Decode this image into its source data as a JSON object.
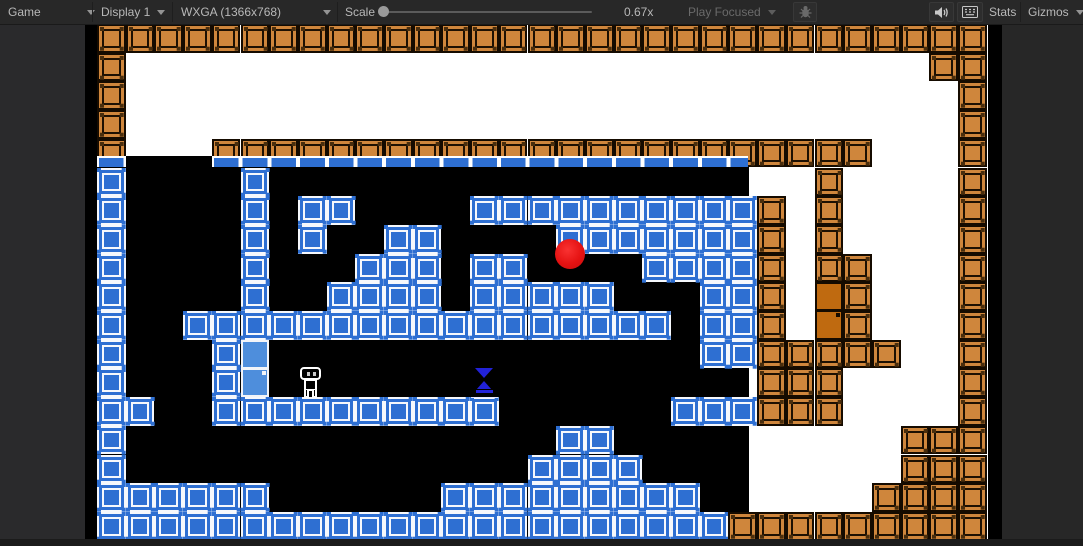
{
  "toolbar": {
    "game_tab": "Game",
    "display_dropdown": "Display 1",
    "resolution_dropdown": "WXGA (1366x768)",
    "scale_label": "Scale",
    "scale_value": "0.67x",
    "play_focused_label": "Play Focused",
    "stats_label": "Stats",
    "gizmos_label": "Gizmos",
    "icons": [
      "bug-icon",
      "audio-volume-icon",
      "keyboard-icon"
    ]
  },
  "editor": {
    "colors": {
      "toolbar_bg": "#282828",
      "panel_bg": "#2a2a2c",
      "bottom_strip": "#1b1b1b",
      "text": "#b8b8b8",
      "text_dim": "#6a6a6a"
    }
  },
  "game": {
    "grid": {
      "cols": 31,
      "rows": 18,
      "tile": 28.7,
      "origin_x": 12,
      "origin_y": 0
    },
    "legend": {
      "O": "orange-crate",
      "B": "blue-crate",
      ".": "cave-black",
      " ": "outside-white"
    },
    "map_rows": [
      "OOOOOOOOOOOOOOOOOOOOOOOOOOOOOOO",
      "O                            OO",
      "O                             O",
      "O                             O",
      "O   OOOOOOOOOOOOOOOOOOOOOOO   O",
      "B....B................   O    O",
      "B....B.BB....BBBBBBBBBBO O    O",
      "B....B.B..BB....BBBBBBBO O    O",
      "B....B...BBB.BB....BBBBO OO   O",
      "B....B..BBBB.BBBBB...BBO  O   O",
      "B..BBBBBBBBBBBBBBBBB.BBO  O   O",
      "B...B................BBOOOOO  O",
      "B...B..................OOO    O",
      "BB..BBBBBBBBBB......BBBOOO    O",
      "B...............BB.....     OOO",
      "B..............BBBB....     OOO",
      "BBBBBB......BBBBBBBBB..    OOOO",
      "BBBBBBBBBBBBBBBBBBBBBBOOOOOOOOO"
    ],
    "overlays": [
      {
        "type": "blue-strip",
        "x": 12,
        "y": 131.5,
        "w": 29,
        "h": 11
      },
      {
        "type": "blue-strip",
        "x": 126.8,
        "y": 131.5,
        "w": 536,
        "h": 11
      },
      {
        "type": "door-blue",
        "x": 155.5,
        "y": 315.7
      },
      {
        "type": "door-orange",
        "x": 729.5,
        "y": 258.3
      },
      {
        "type": "ball",
        "x": 470,
        "y": 215
      },
      {
        "type": "player",
        "x": 215,
        "y": 343
      },
      {
        "type": "hourglass",
        "x": 386,
        "y": 339
      }
    ],
    "colors": {
      "orange_crate": "#cf863c",
      "crate_outline": "#1d1002",
      "blue_crate": "#2e6fd2",
      "crate_white": "#ffffff",
      "cave": "#000000",
      "outside": "#ffffff",
      "door_blue": "#4e8edc",
      "door_orange": "#bf6a10",
      "ball_red": "#e51212",
      "hourglass_sand_blue": "#2222d8"
    }
  }
}
